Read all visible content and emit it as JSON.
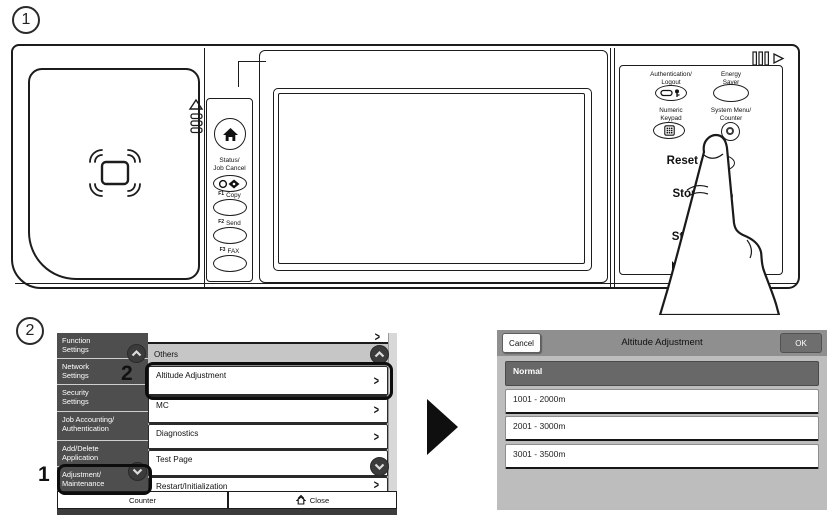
{
  "step_markers": {
    "one": "1",
    "two": "2"
  },
  "icons": {
    "chevron_right": ">"
  },
  "device": {
    "strip": {
      "status_label": "Status/\nJob Cancel",
      "keys": [
        {
          "fn": "F1",
          "name": "Copy"
        },
        {
          "fn": "F2",
          "name": "Send"
        },
        {
          "fn": "F3",
          "name": "FAX"
        }
      ]
    },
    "right_panel": {
      "auth_label": "Authentication/\nLogout",
      "energy_label": "Energy\nSaver",
      "numeric_label": "Numeric\nKeypad",
      "system_menu_label": "System Menu/\nCounter",
      "reset_label": "Reset",
      "stop_label": "Stop",
      "start_label": "Start"
    }
  },
  "screen1": {
    "sidebar_items": [
      {
        "label": "Function\nSettings"
      },
      {
        "label": "Network\nSettings"
      },
      {
        "label": "Security\nSettings"
      },
      {
        "label": "Job Accounting/\nAuthentication"
      },
      {
        "label": "Add/Delete\nApplication"
      },
      {
        "label": "Adjustment/\nMaintenance"
      }
    ],
    "list_header": "Others",
    "list_items": [
      "Altitude Adjustment",
      "MC",
      "Diagnostics",
      "Test Page",
      "Restart/Initialization"
    ],
    "footer": {
      "counter": "Counter",
      "close": "Close"
    },
    "callouts": {
      "one": "1",
      "two": "2"
    }
  },
  "screen2": {
    "cancel": "Cancel",
    "title": "Altitude Adjustment",
    "ok": "OK",
    "options": [
      "Normal",
      "1001 - 2000m",
      "2001 - 3000m",
      "3001 - 3500m"
    ],
    "selected_option": "Normal"
  },
  "colors": {
    "outline": "#1c1c1c",
    "sidebar_bg": "#4e4e4e",
    "list_header_bg": "#c6c6c6",
    "scroll_circle": "#3b3b3b",
    "dialog_header_bg": "#8f8f8f",
    "dialog_body_bg": "#bdbdbd",
    "selected_row_bg": "#686868",
    "ok_button_bg": "#6e6e6e",
    "footer_strip": "#3c3c3c"
  }
}
